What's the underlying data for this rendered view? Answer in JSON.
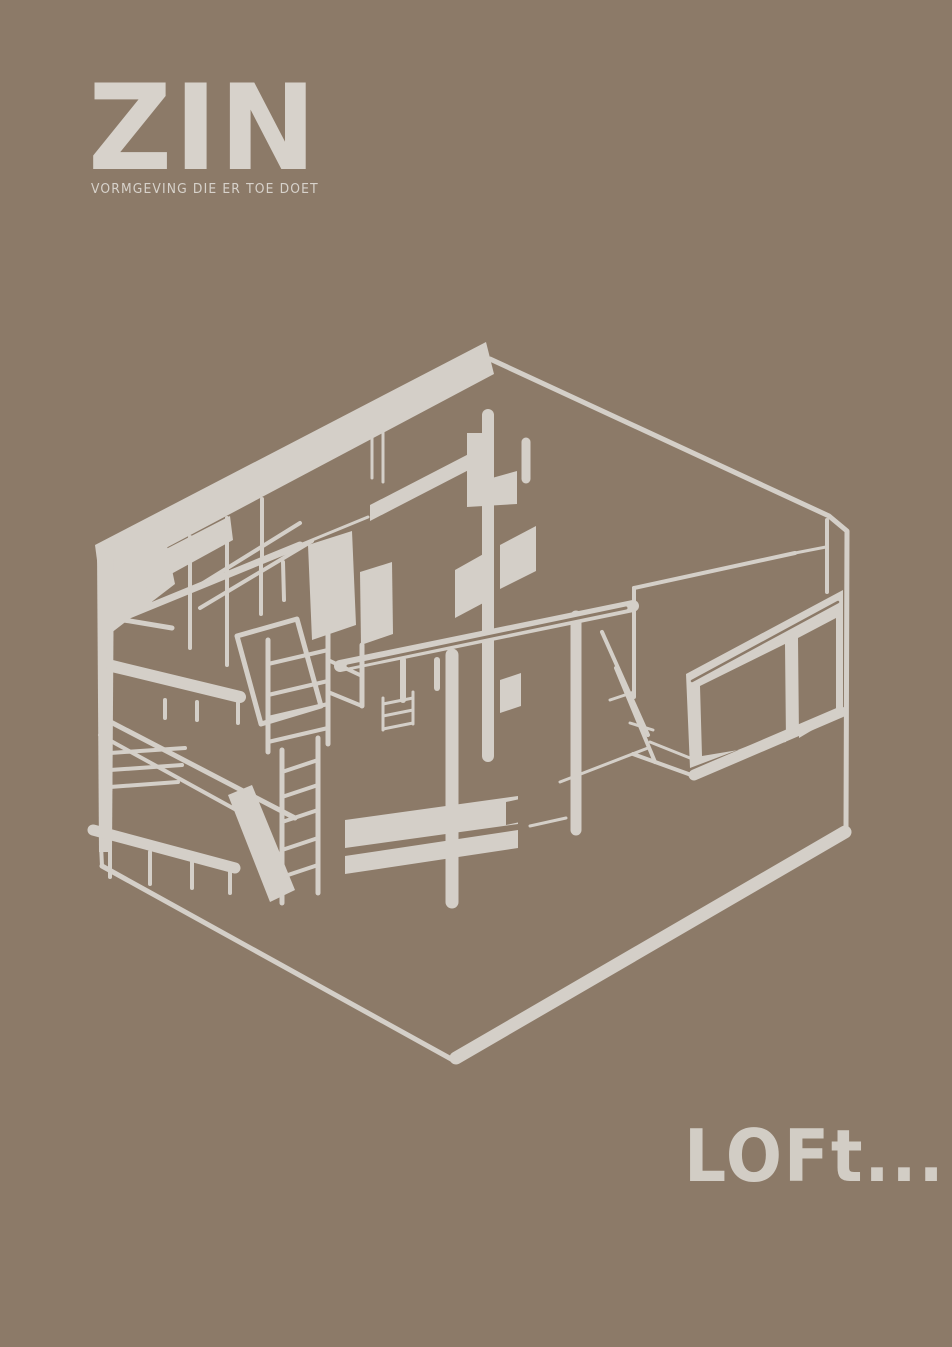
{
  "poster": {
    "colors": {
      "background": "#8c7a68",
      "ink": "#d4cfc8",
      "logo": "#d7d2cb",
      "caption": "#d2cdc5"
    },
    "logo": {
      "title": "ZIN",
      "tagline": "VORMGEVING DIE ER TOE DOET"
    },
    "sketch": {
      "label": "Hand-drawn isometric line sketch of a loft interior with roof beam, columns, stairs, ladder, railings, benches, cabinets and a large window wall"
    },
    "caption": {
      "text": "LOFt..."
    }
  }
}
